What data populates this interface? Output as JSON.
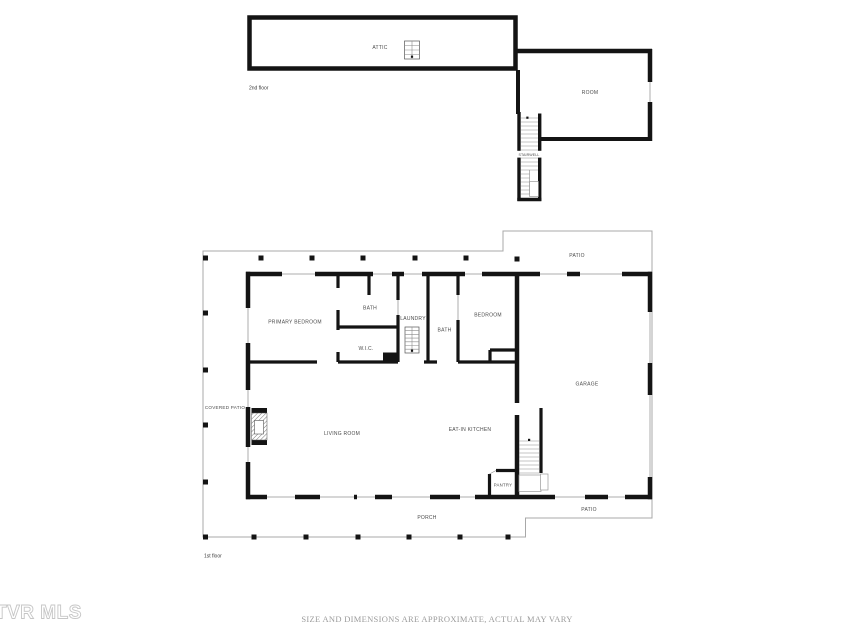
{
  "floors": {
    "second": {
      "label": "2nd floor",
      "rooms": {
        "attic": "ATTIC",
        "room": "ROOM",
        "stairwell": "STAIRWELL"
      }
    },
    "first": {
      "label": "1st floor",
      "rooms": {
        "primary_bedroom": "PRIMARY BEDROOM",
        "bath1": "BATH",
        "wic": "W.I.C.",
        "laundry": "LAUNDRY",
        "bath2": "BATH",
        "bedroom": "BEDROOM",
        "living_room": "LIVING ROOM",
        "eat_in_kitchen": "EAT-IN KITCHEN",
        "pantry": "PANTRY",
        "garage": "GARAGE",
        "covered_patio": "COVERED PATIO",
        "patio_upper": "PATIO",
        "patio_lower": "PATIO",
        "porch": "PORCH"
      }
    }
  },
  "watermark": "TVR MLS",
  "disclaimer": "SIZE AND DIMENSIONS ARE APPROXIMATE, ACTUAL MAY VARY",
  "colors": {
    "wall": "#141414",
    "outline": "#a8a8a8",
    "window": "#c8c8c8",
    "label": "#4b4b4b",
    "disclaimer": "#9b9b9b",
    "watermark": "#c6c6c6"
  }
}
